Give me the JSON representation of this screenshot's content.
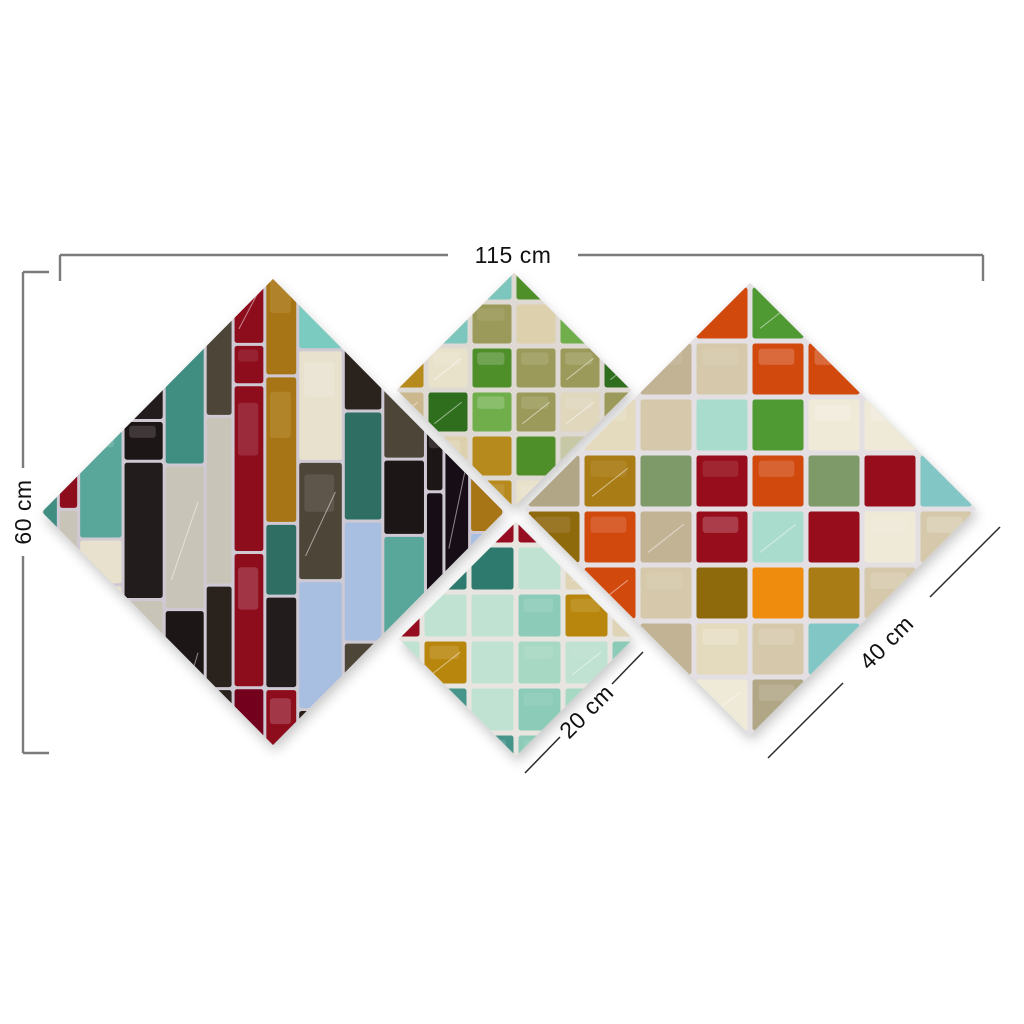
{
  "page": {
    "background": "#ffffff"
  },
  "diagram": {
    "type": "product-dimension-diagram",
    "subject": "four-piece diamond stained-glass mosaic canvas wall art set",
    "labels": {
      "total_width": "115 cm",
      "total_height": "60 cm",
      "small_panel_edge": "20 cm",
      "large_panel_edge": "40 cm"
    },
    "style": {
      "dim_line_color": "#7b7b7b",
      "diag_dim_line_color": "#2a2a2a",
      "dim_text_color": "#111111",
      "shadow_color": "#000000"
    },
    "panels": [
      {
        "name": "left-large-diamond",
        "cx": 273,
        "cy": 512,
        "rx": 231,
        "ry": 233,
        "pattern": "columns",
        "seed": 7,
        "grout": "#cfc9d3",
        "accent_stripe": "#8e0e1f",
        "accent_stripe_alt": "#73001a",
        "palette": [
          "#1b1313",
          "#251b17",
          "#171017",
          "#2a201c",
          "#3f8e82",
          "#58a79a",
          "#2e6e63",
          "#7ccbc0",
          "#1b1313",
          "#8e0e1f",
          "#c9c4b8",
          "#e7e1cd",
          "#a9bfe2",
          "#a87513",
          "#4d4438",
          "#3f8e82",
          "#241a1a"
        ]
      },
      {
        "name": "top-middle-small-diamond",
        "cx": 514,
        "cy": 390,
        "rx": 117,
        "ry": 117,
        "pattern": "grid",
        "pitch": 44,
        "seed": 13,
        "grout": "#ded9d2",
        "palette": [
          "#4f8f2b",
          "#6fae4b",
          "#2f6e1e",
          "#cbb88f",
          "#dcd0ad",
          "#e9e2cb",
          "#c6c8a6",
          "#7cc6bd",
          "#b68a1f",
          "#9c9a5a",
          "#e0d7bd",
          "#cbb88f",
          "#4f8f2b"
        ]
      },
      {
        "name": "bottom-middle-small-diamond",
        "cx": 516,
        "cy": 639,
        "rx": 117,
        "ry": 117,
        "pattern": "grid",
        "pitch": 47,
        "seed": 21,
        "grout": "#e8e5e0",
        "palette": [
          "#a6d8c3",
          "#bfe2d2",
          "#8ccbb8",
          "#47958a",
          "#2e7a6e",
          "#961021",
          "#dfd4b5",
          "#b8860b",
          "#4a8a2a",
          "#a6d8c3",
          "#bfe2d2",
          "#9fd4c0"
        ]
      },
      {
        "name": "right-large-diamond",
        "cx": 750,
        "cy": 509,
        "rx": 226,
        "ry": 226,
        "pattern": "grid",
        "pitch": 56,
        "seed": 29,
        "grout": "#e3dfe3",
        "palette": [
          "#82c7c6",
          "#5fb0b4",
          "#a9dccd",
          "#e4dabd",
          "#d6c9ab",
          "#c2b394",
          "#b1a685",
          "#7d9a67",
          "#4f9a33",
          "#a97c17",
          "#97101e",
          "#d2490f",
          "#e4dabd",
          "#82c7c6",
          "#d6c9ab",
          "#efe9d8",
          "#8f6a10",
          "#ef8c07"
        ]
      }
    ]
  }
}
